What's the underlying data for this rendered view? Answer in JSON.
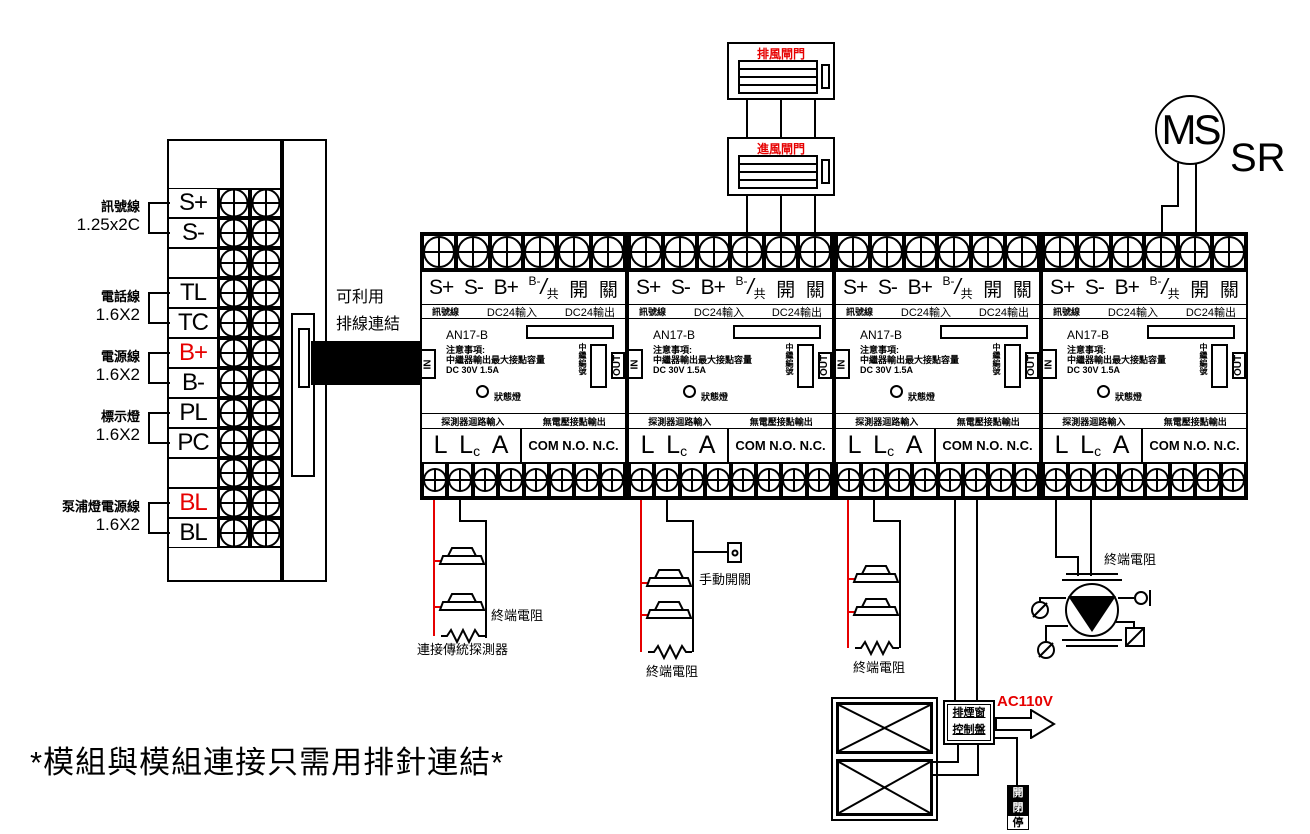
{
  "colors": {
    "line": "#000000",
    "accent_red": "#e60000",
    "background": "#ffffff"
  },
  "left_block": {
    "groups": [
      {
        "name": "訊號線",
        "size": "1.25x2C"
      },
      {
        "name": "電話線",
        "size": "1.6X2"
      },
      {
        "name": "電源線",
        "size": "1.6X2"
      },
      {
        "name": "標示燈",
        "size": "1.6X2"
      },
      {
        "name": "泵浦燈電源線",
        "size": "1.6X2"
      }
    ],
    "rows": [
      "S+",
      "S-",
      "",
      "TL",
      "TC",
      "B+",
      "B-",
      "PL",
      "PC",
      "",
      "BL",
      "BL"
    ]
  },
  "ribbon_note": {
    "line1": "可利用",
    "line2": "排線連結"
  },
  "module": {
    "model": "AN17-B",
    "terminals": {
      "t1": "S+",
      "t2": "S-",
      "t3": "B+",
      "t4_top": "B-",
      "t4_slash": "/",
      "t4_bottom": "共",
      "t5": "開",
      "t6": "關"
    },
    "sublabels": {
      "signal": "訊號線",
      "dc_in": "DC24輸入",
      "dc_out": "DC24輸出"
    },
    "note": {
      "title": "注意事項:",
      "line1": "中繼器輸出最大接點容量",
      "line2": "DC 30V 1.5A"
    },
    "ports": {
      "in": "IN",
      "out": "OUT"
    },
    "relay_no_label": "中繼編號",
    "status_label": "狀態燈",
    "bottom_labels": {
      "input": "探測器迴路輸入",
      "output": "無電壓接點輸出"
    },
    "bottom_terminals": {
      "l": "L",
      "lc_main": "L",
      "lc_sub": "c",
      "a": "A",
      "contacts": "COM N.O. N.C."
    }
  },
  "dampers": {
    "exhaust": "排風閘門",
    "intake": "進風閘門"
  },
  "motor": {
    "label": "MS",
    "type": "SR"
  },
  "annotations": {
    "end_resistor": "終端電阻",
    "conventional_detectors": "連接傳統探測器",
    "manual_switch": "手動開關"
  },
  "control": {
    "panel_line1": "排煙窗",
    "panel_line2": "控制盤",
    "voltage": "AC110V",
    "buttons": [
      "開",
      "閉",
      "停"
    ]
  },
  "footnote": "*模組與模組連接只需用排針連結*"
}
